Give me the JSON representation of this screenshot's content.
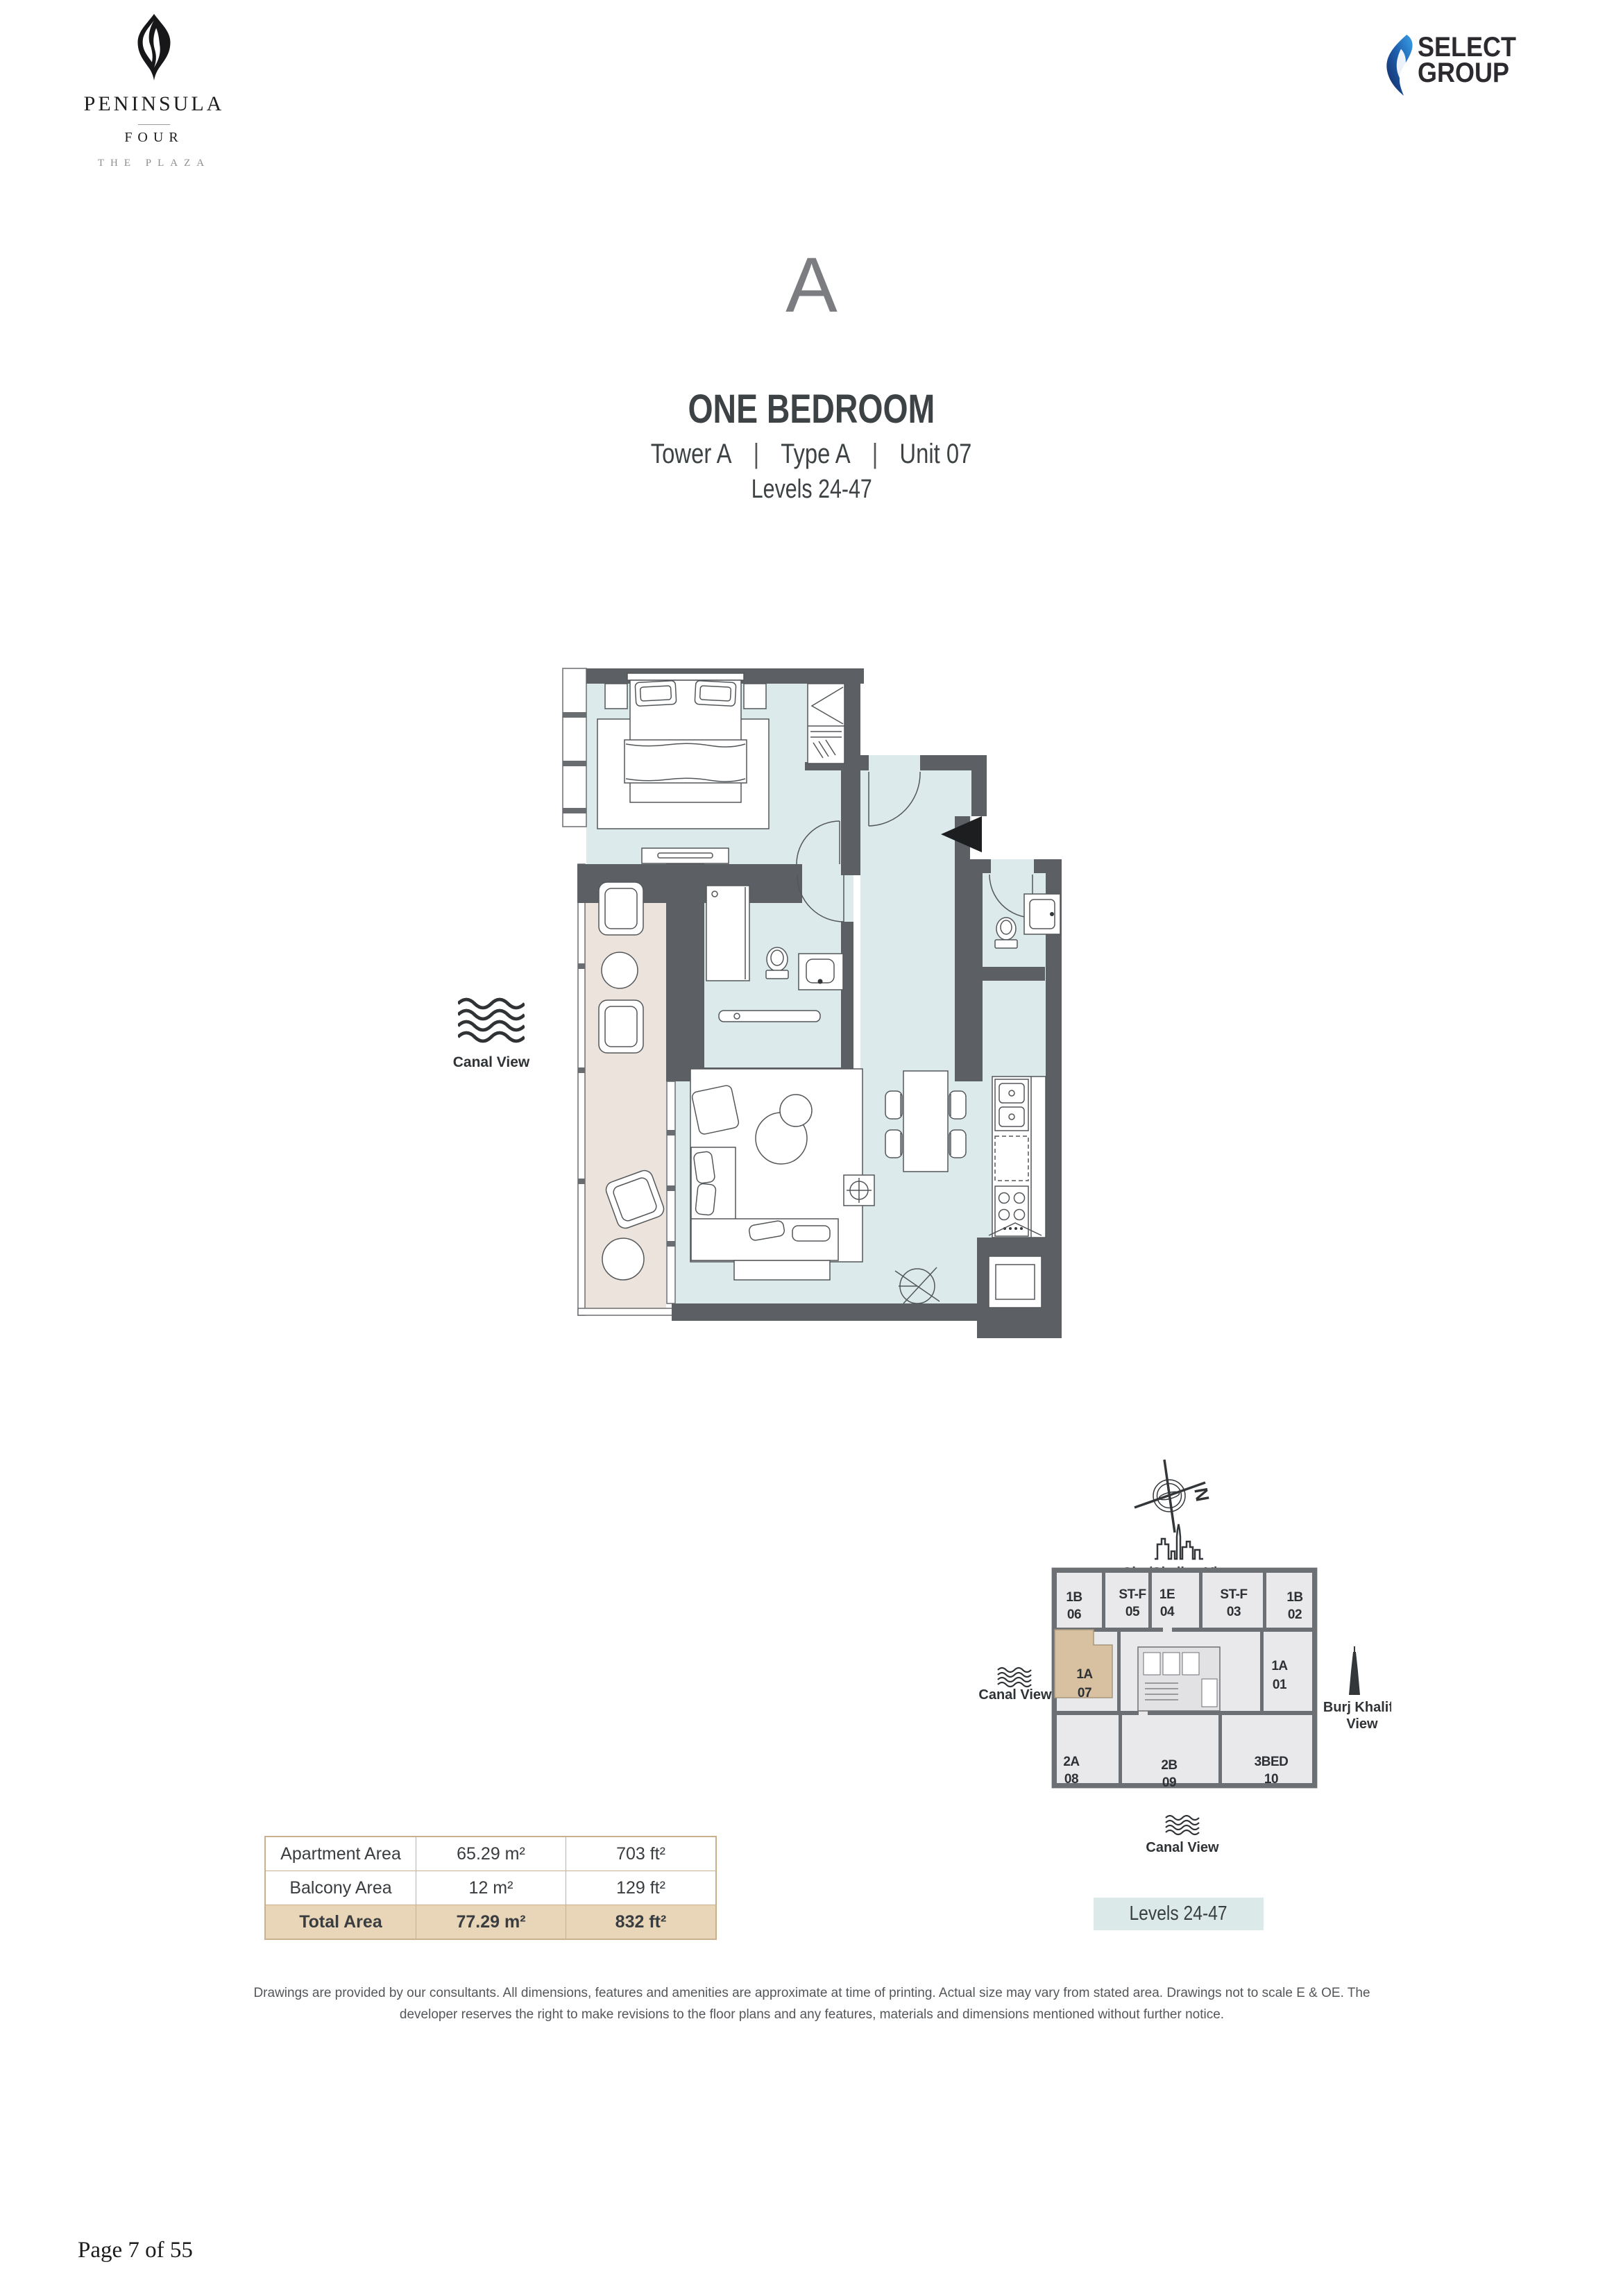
{
  "brand": {
    "name": "PENINSULA",
    "sub": "FOUR",
    "tagline": "THE PLAZA"
  },
  "developer": {
    "line1": "SELECT",
    "line2": "GROUP"
  },
  "title": {
    "plan_letter": "A",
    "unit_type": "ONE BEDROOM",
    "tower": "Tower A",
    "type": "Type A",
    "unit": "Unit 07",
    "separator": "|",
    "levels": "Levels 24-47"
  },
  "floorplan": {
    "canal_view_label": "Canal View"
  },
  "keyplan": {
    "north_label": "N",
    "city_view_label": "City/Skyline View",
    "canal_view_left_label": "Canal View",
    "canal_view_bottom_label": "Canal View",
    "burj_line1": "Burj Khalifa",
    "burj_line2": "View",
    "levels_badge": "Levels 24-47",
    "units": [
      {
        "type": "1B",
        "num": "06"
      },
      {
        "type": "ST-F",
        "num": "05"
      },
      {
        "type": "1E",
        "num": "04"
      },
      {
        "type": "ST-F",
        "num": "03"
      },
      {
        "type": "1B",
        "num": "02"
      },
      {
        "type": "1A",
        "num": "07"
      },
      {
        "type": "1A",
        "num": "01"
      },
      {
        "type": "2A",
        "num": "08"
      },
      {
        "type": "2B",
        "num": "09"
      },
      {
        "type": "3BED",
        "num": "10"
      }
    ]
  },
  "area_table": {
    "rows": [
      {
        "label": "Apartment Area",
        "metric": "65.29 m²",
        "imperial": "703 ft²"
      },
      {
        "label": "Balcony Area",
        "metric": "12 m²",
        "imperial": "129 ft²"
      },
      {
        "label": "Total Area",
        "metric": "77.29 m²",
        "imperial": "832 ft²"
      }
    ]
  },
  "disclaimer": "Drawings are provided by our consultants. All dimensions, features and amenities are approximate at time of printing.  Actual size may vary from stated area. Drawings not to scale E & OE. The developer reserves the right to make revisions to the floor plans and any features, materials and dimensions mentioned without further notice.",
  "footer": {
    "page_label": "Page 7 of 55"
  },
  "colors": {
    "wall": "#5c6064",
    "floor": "#dceaeb",
    "balcony": "#ece4dc",
    "keyplan_highlight": "#d8c1a1",
    "badge_bg": "#dbe9e9",
    "table_border": "#c9b190",
    "table_total_bg": "#e9d6b9",
    "flame_blue_dark": "#14265c",
    "flame_blue_light": "#3aa0e8"
  }
}
